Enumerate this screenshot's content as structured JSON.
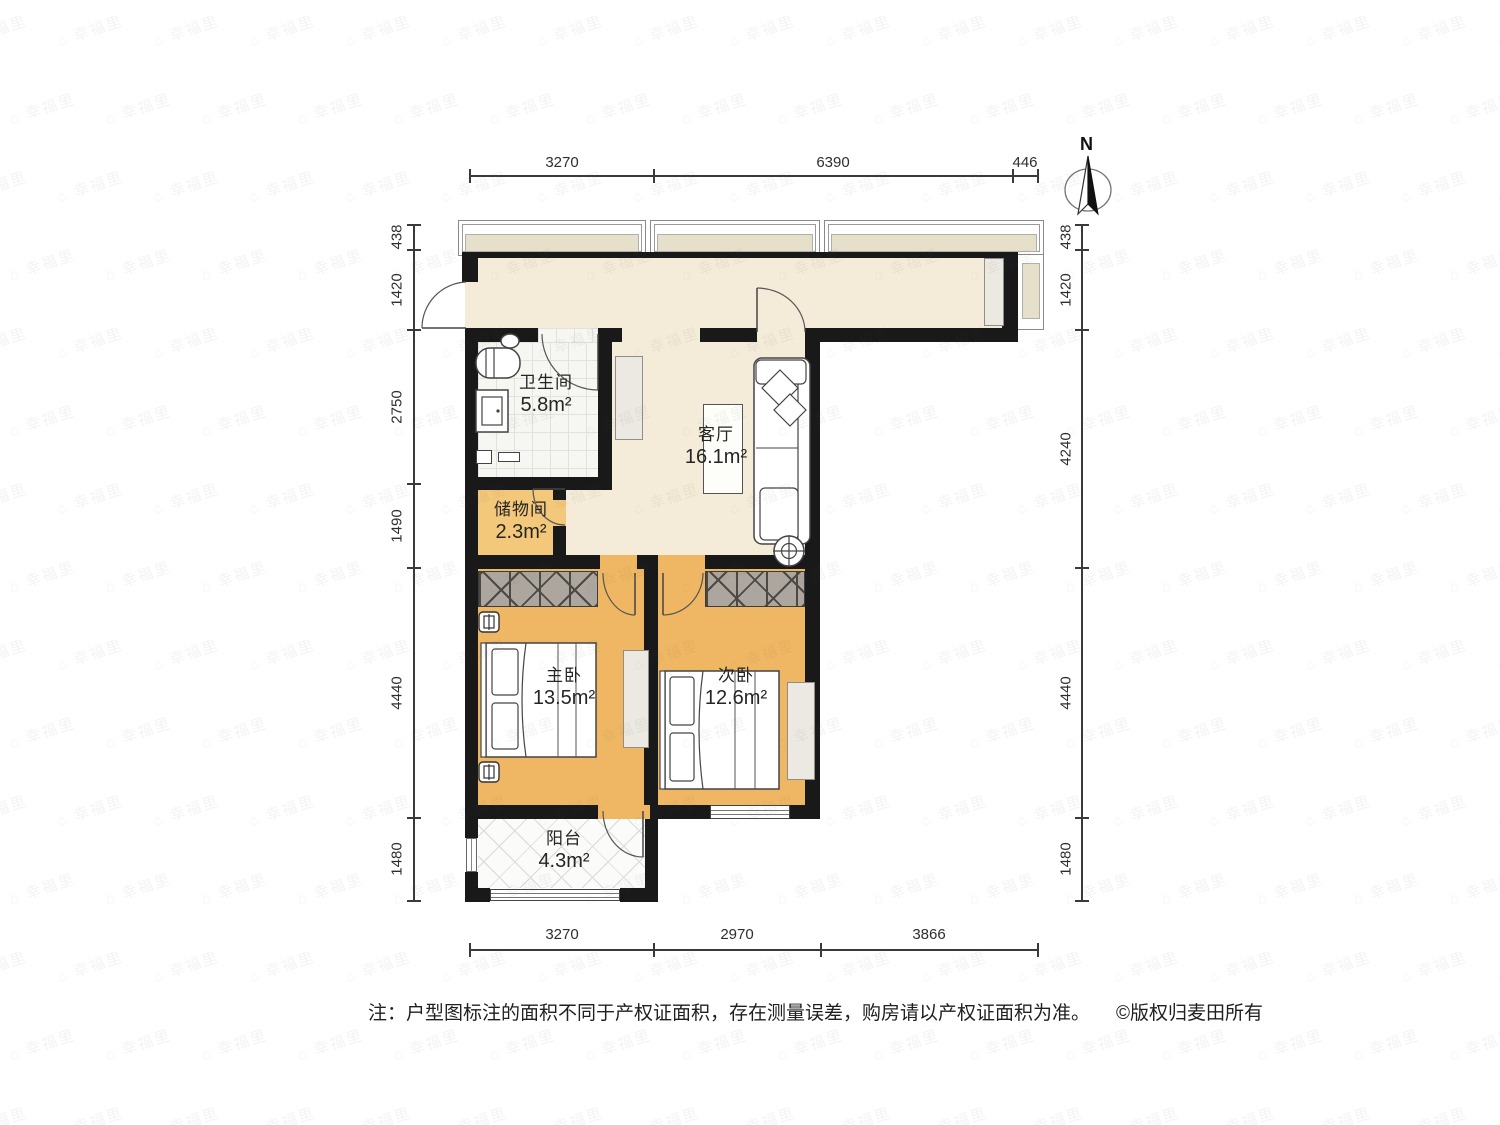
{
  "watermark": {
    "icon": "⌂",
    "text": "幸福里"
  },
  "north": {
    "label": "N"
  },
  "rooms": {
    "bathroom": {
      "name": "卫生间",
      "area": "5.8m²"
    },
    "living": {
      "name": "客厅",
      "area": "16.1m²"
    },
    "storage": {
      "name": "储物间",
      "area": "2.3m²"
    },
    "master": {
      "name": "主卧",
      "area": "13.5m²"
    },
    "second": {
      "name": "次卧",
      "area": "12.6m²"
    },
    "balcony": {
      "name": "阳台",
      "area": "4.3m²"
    }
  },
  "dimensions": {
    "top": [
      "3270",
      "6390",
      "446"
    ],
    "bottom": [
      "3270",
      "2970",
      "3866"
    ],
    "left": [
      "438",
      "1420",
      "2750",
      "1490",
      "4440",
      "1480"
    ],
    "right": [
      "438",
      "1420",
      "4240",
      "4440",
      "1480"
    ]
  },
  "footer": {
    "note": "注：户型图标注的面积不同于产权证面积，存在测量误差，购房请以产权证面积为准。",
    "copyright": "©版权归麦田所有"
  },
  "colors": {
    "floor_main": "#f4ecd8",
    "floor_bedroom": "#efb763",
    "floor_storage": "#f3c87a",
    "window_glass": "#e6dfca",
    "wardrobe": "#ada69f",
    "wall": "#191919"
  }
}
